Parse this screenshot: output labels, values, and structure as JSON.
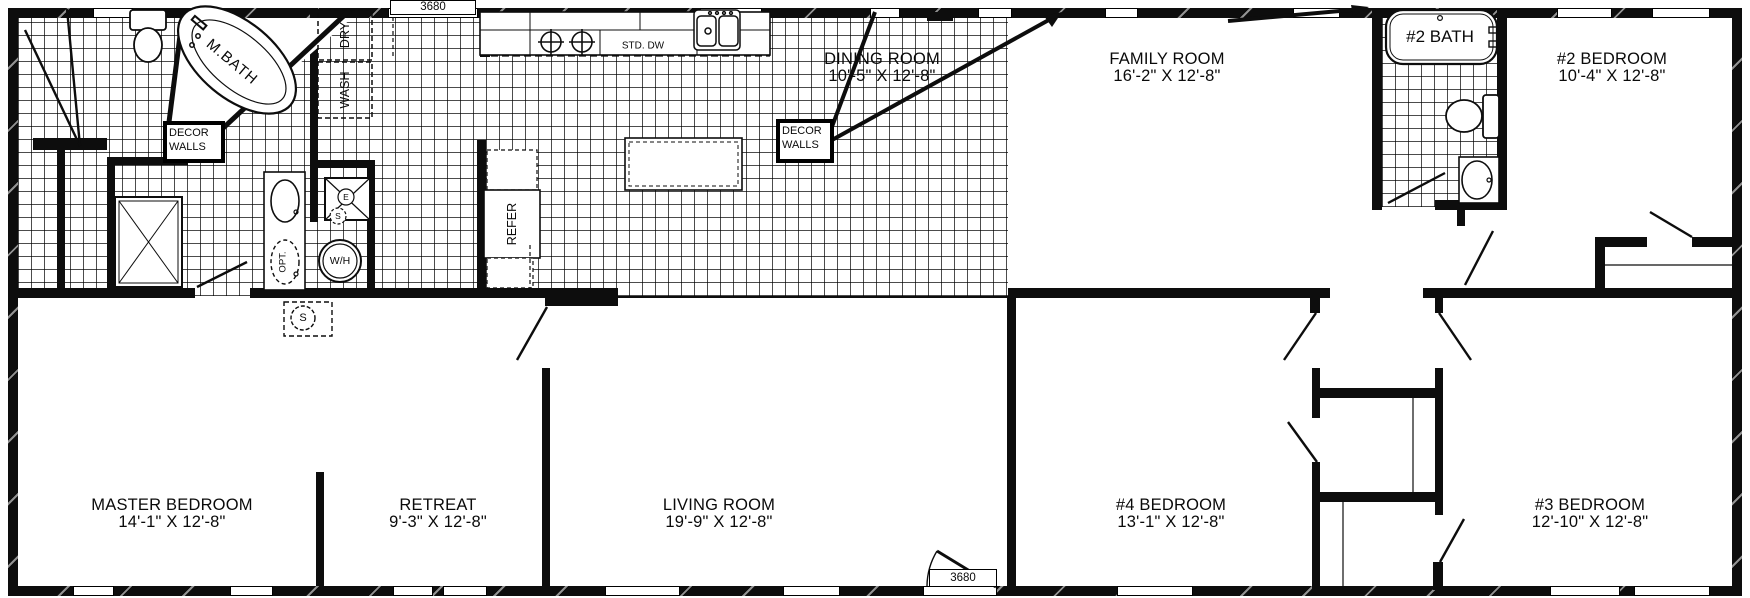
{
  "floorplan": {
    "door_size_label": "3680",
    "rooms": {
      "master": {
        "name": "MASTER BEDROOM",
        "dims": "14'-1\" X 12'-8\""
      },
      "retreat": {
        "name": "RETREAT",
        "dims": "9'-3\" X 12'-8\""
      },
      "living": {
        "name": "LIVING ROOM",
        "dims": "19'-9\" X 12'-8\""
      },
      "bed4": {
        "name": "#4 BEDROOM",
        "dims": "13'-1\" X 12'-8\""
      },
      "bed3": {
        "name": "#3 BEDROOM",
        "dims": "12'-10\" X 12'-8\""
      },
      "dining": {
        "name": "DINING ROOM",
        "dims": "10'-5\" X 12'-8\""
      },
      "family": {
        "name": "FAMILY ROOM",
        "dims": "16'-2\" X 12'-8\""
      },
      "bed2": {
        "name": "#2 BEDROOM",
        "dims": "10'-4\" X 12'-8\""
      },
      "bath2": {
        "name": "#2 BATH"
      },
      "mbath": {
        "name": "M.BATH"
      }
    },
    "callouts": {
      "decor_walls": "DECOR\nWALLS"
    },
    "fixtures": {
      "wash": "WASH",
      "dry": "DRY",
      "refer": "REFER",
      "water_heater": "W/H",
      "opt": "OPT.",
      "std_dw": "STD. DW",
      "s_marker": "S",
      "e_marker": "E"
    }
  }
}
